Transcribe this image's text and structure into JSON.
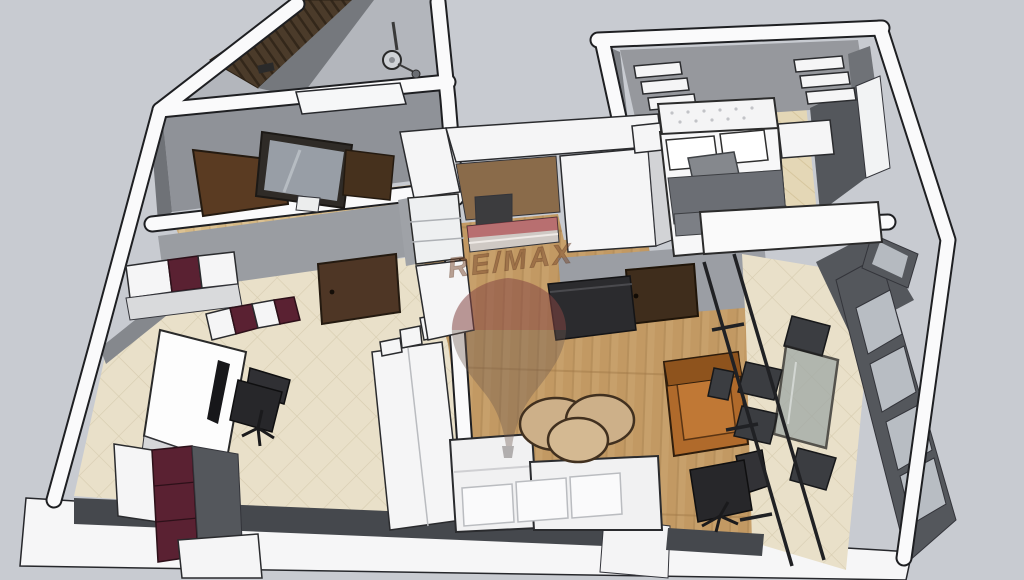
{
  "watermark": {
    "brand_text": "RE/MAX",
    "balloon_icon": "remax-balloon-icon"
  },
  "palette": {
    "background": "#c8cbd1",
    "wall_white": "#fafafb",
    "wall_outline": "#1e1f22",
    "wall_gray_face": "#8f9298",
    "wall_dark_face": "#54575c",
    "wood_floor": "#c7a06b",
    "hall_wood_floor": "#dcc293",
    "tile_floor": "#e9e0c9",
    "bedroom_carpet": "#e4d7b6",
    "accent_wall_gray": "#96989d",
    "slat_wall_brown": "#4b3b2a",
    "door_brown": "#5a3b22",
    "bedroom_door_brown": "#3f2d1c",
    "cabinet_maroon": "#5a2132",
    "sofa_white": "#f1f1f2",
    "armchair_leather": "#b06a2b",
    "chair_black": "#27272a",
    "blanket_gray": "#6b6e74",
    "tv_wall_gray": "#45484d",
    "glass_gray": "#9fa8a5",
    "watermark_red": "#a83338",
    "watermark_text_brown": "#7a4a2e",
    "watermark_balloon_tint": "#6b564b"
  }
}
